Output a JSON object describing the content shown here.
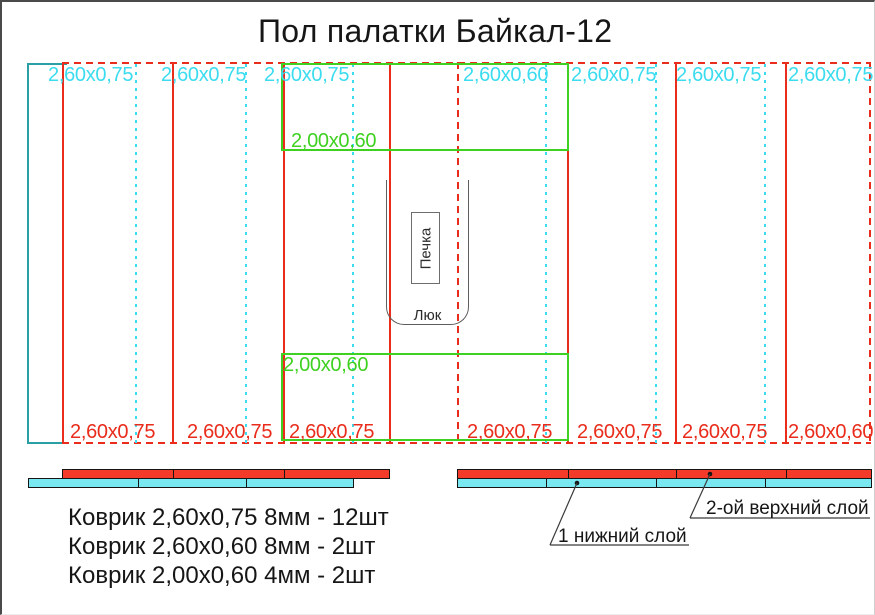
{
  "title": "Пол палатки Байкал-12",
  "floor": {
    "top_labels": [
      "2,60х0,75",
      "2,60х0,75",
      "2,60х0,75",
      "2,60х0,60",
      "2,60х0,75",
      "2,60х0,75",
      "2,60х0,75"
    ],
    "bottom_labels": [
      "2,60х0,75",
      "2,60х0,75",
      "2,60х0,75",
      "2,60х0,75",
      "2,60х0,75",
      "2,60х0,75",
      "2,60х0,60"
    ],
    "inner_top_label": "2,00х0,60",
    "inner_bottom_label": "2,00х0,60",
    "stove_label": "Печка",
    "hatch_label": "Люк"
  },
  "layers": {
    "top_layer_label": "2-ой верхний слой",
    "bottom_layer_label": "1 нижний слой"
  },
  "legend": {
    "lines": [
      "Коврик 2,60х0,75 8мм - 12шт",
      "Коврик 2,60х0,60 8мм - 2шт",
      "Коврик 2,00х0,60 4мм - 2шт"
    ]
  },
  "colors": {
    "red_line": "#e92c1b",
    "cyan_line": "#3bdcef",
    "teal_border": "#2aa0a5",
    "green_line": "#3fd121",
    "red_fill": "#f43b2a",
    "cyan_fill": "#7ae8f0"
  }
}
